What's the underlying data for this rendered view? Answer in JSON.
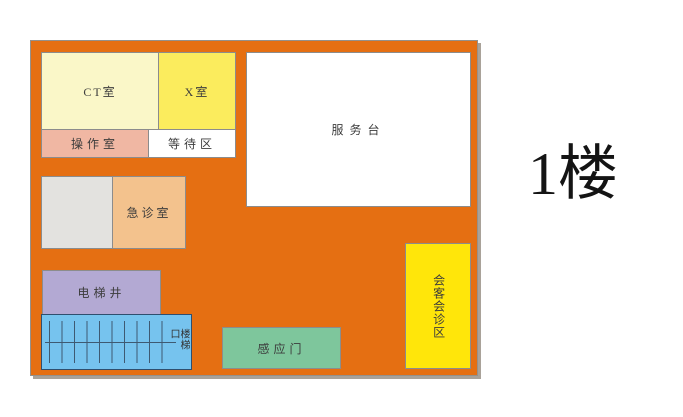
{
  "title": "1楼",
  "floor": {
    "color": "#e56f12",
    "shadow_color": "#a9a299",
    "stair_line_color": "#3e5a72"
  },
  "rooms": [
    {
      "id": "ct-room",
      "label": "CT室",
      "color": "#faf7c8"
    },
    {
      "id": "x-room",
      "label": "X室",
      "color": "#fbec5d"
    },
    {
      "id": "operation-room",
      "label": "操作室",
      "color": "#f0b7a3"
    },
    {
      "id": "waiting-area",
      "label": "等待区",
      "color": "#ffffff"
    },
    {
      "id": "service-desk",
      "label": "服务台",
      "color": "#ffffff"
    },
    {
      "id": "utility-room",
      "label": "",
      "color": "#e3e2df"
    },
    {
      "id": "emergency-room",
      "label": "急诊室",
      "color": "#f3c28d"
    },
    {
      "id": "elevator-shaft",
      "label": "电梯井",
      "color": "#b3a9d3"
    },
    {
      "id": "stairway",
      "label": "楼梯口",
      "color": "#76c3ee"
    },
    {
      "id": "sensor-door",
      "label": "感应门",
      "color": "#7ec69c"
    },
    {
      "id": "meeting-area",
      "label": "会客会诊区",
      "color": "#ffe60a"
    }
  ]
}
